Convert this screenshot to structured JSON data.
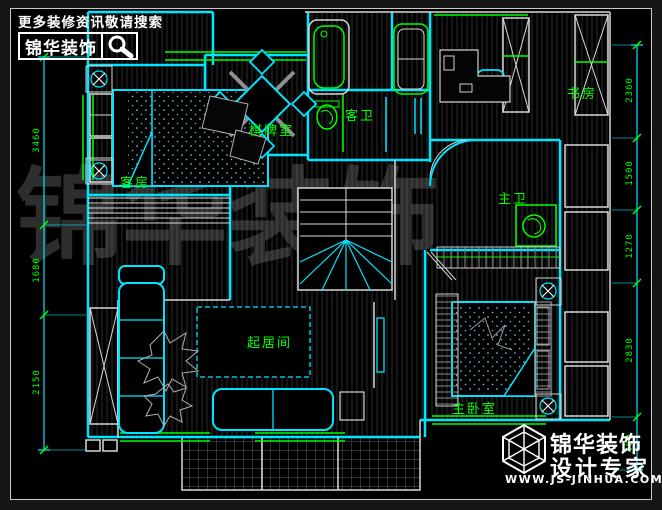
{
  "header": {
    "tagline": "更多装修资讯敬请搜索",
    "brand": "锦华装饰"
  },
  "rooms": [
    {
      "id": "guest-room",
      "label": "客房"
    },
    {
      "id": "chess-room",
      "label": "棋牌室"
    },
    {
      "id": "guest-bath",
      "label": "客卫"
    },
    {
      "id": "study",
      "label": "书房"
    },
    {
      "id": "master-bath",
      "label": "主卫"
    },
    {
      "id": "living-room",
      "label": "起居间"
    },
    {
      "id": "master-bedroom",
      "label": "主卧室"
    }
  ],
  "dimensions": {
    "left": [
      "3460",
      "1680",
      "2150"
    ],
    "right": [
      "2360",
      "1500",
      "1270",
      "2830",
      "480"
    ]
  },
  "watermark": {
    "text": "锦华装饰"
  },
  "footer": {
    "brand": "锦华装饰",
    "tagline": "设计专家",
    "website": "WWW.JS-JINHUA.COM"
  },
  "colors": {
    "background": "#000000",
    "wall_cyan": "#00e5ff",
    "accent_green": "#00ff00",
    "line_white": "#d8d8d8",
    "watermark_gray": "#969696"
  }
}
